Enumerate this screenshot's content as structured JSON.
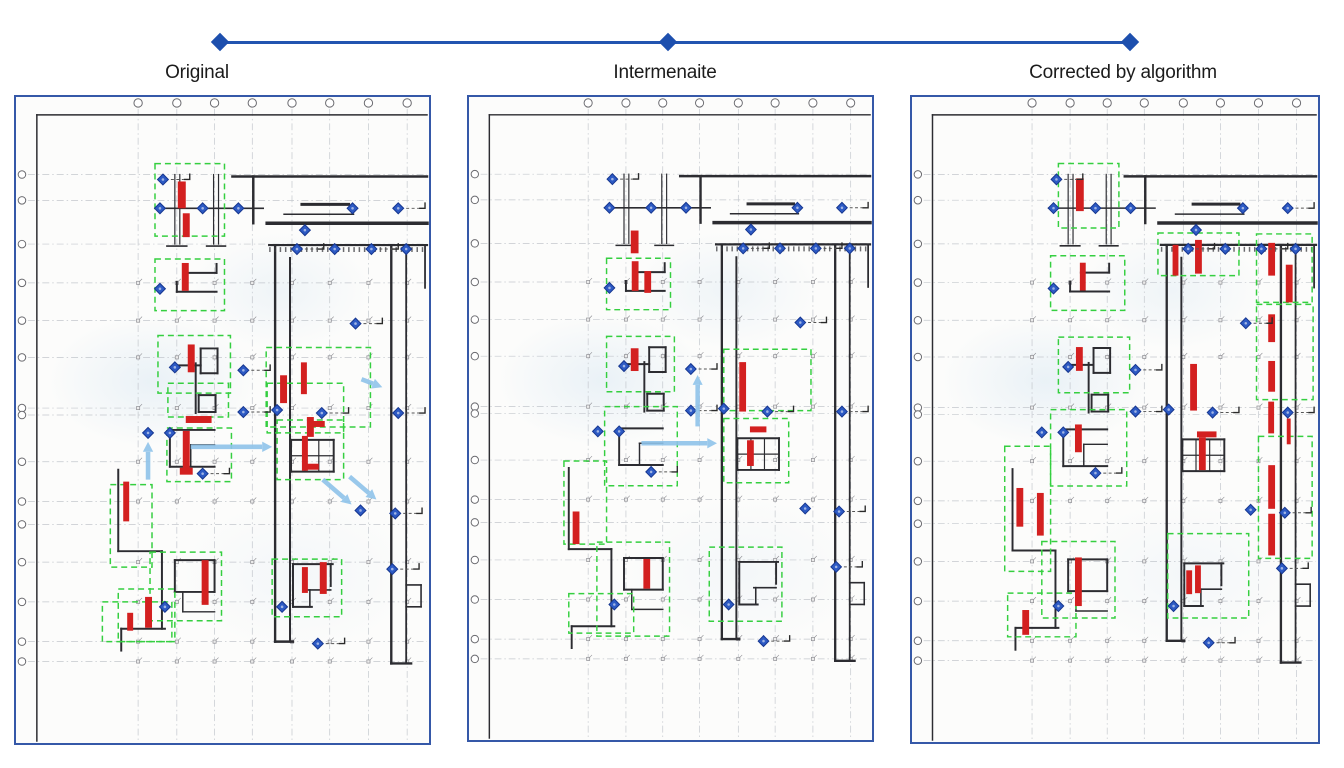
{
  "timeline": {
    "y": 42,
    "marker_xs": [
      220,
      668,
      1130
    ],
    "color": "#1d4fae",
    "line_color": "#2254b0"
  },
  "panels": [
    {
      "label": "Original",
      "red_marks": [
        [
          163,
          85,
          8,
          27
        ],
        [
          168,
          117,
          7,
          24
        ],
        [
          167,
          167,
          7,
          28
        ],
        [
          173,
          249,
          7,
          28
        ],
        [
          266,
          280,
          7,
          28
        ],
        [
          287,
          267,
          6,
          32
        ],
        [
          171,
          321,
          26,
          7
        ],
        [
          293,
          322,
          7,
          20
        ],
        [
          168,
          336,
          7,
          41
        ],
        [
          165,
          373,
          13,
          7
        ],
        [
          108,
          387,
          6,
          40
        ],
        [
          288,
          341,
          6,
          35
        ],
        [
          295,
          326,
          16,
          6
        ],
        [
          292,
          369,
          13,
          6
        ],
        [
          187,
          466,
          7,
          45
        ],
        [
          288,
          473,
          6,
          26
        ],
        [
          306,
          468,
          7,
          32
        ],
        [
          112,
          519,
          6,
          18
        ],
        [
          130,
          503,
          7,
          31
        ]
      ],
      "green_boxes": [
        [
          140,
          67,
          70,
          73
        ],
        [
          140,
          163,
          70,
          52
        ],
        [
          143,
          240,
          73,
          58
        ],
        [
          153,
          288,
          61,
          34
        ],
        [
          252,
          252,
          105,
          80
        ],
        [
          253,
          288,
          77,
          50
        ],
        [
          152,
          333,
          65,
          54
        ],
        [
          263,
          325,
          67,
          60
        ],
        [
          95,
          390,
          42,
          83
        ],
        [
          135,
          458,
          72,
          69
        ],
        [
          103,
          495,
          57,
          53
        ],
        [
          87,
          508,
          70,
          40
        ],
        [
          258,
          465,
          70,
          58
        ]
      ],
      "arrows": [
        [
          133,
          385,
          133,
          347
        ],
        [
          176,
          352,
          258,
          352
        ],
        [
          309,
          385,
          338,
          410
        ],
        [
          336,
          382,
          363,
          405
        ],
        [
          348,
          284,
          369,
          292
        ]
      ]
    },
    {
      "label": "Intermenaite",
      "red_marks": [
        [
          167,
          135,
          8,
          23
        ],
        [
          168,
          166,
          7,
          30
        ],
        [
          181,
          176,
          7,
          22
        ],
        [
          167,
          254,
          8,
          23
        ],
        [
          279,
          268,
          7,
          50
        ],
        [
          290,
          333,
          17,
          6
        ],
        [
          287,
          347,
          7,
          26
        ],
        [
          107,
          419,
          7,
          33
        ],
        [
          180,
          467,
          7,
          30
        ]
      ],
      "green_boxes": [
        [
          142,
          163,
          66,
          52
        ],
        [
          142,
          242,
          70,
          56
        ],
        [
          263,
          255,
          90,
          62
        ],
        [
          263,
          325,
          67,
          65
        ],
        [
          140,
          313,
          75,
          80
        ],
        [
          98,
          368,
          44,
          84
        ],
        [
          132,
          450,
          75,
          95
        ],
        [
          103,
          502,
          67,
          40
        ],
        [
          248,
          455,
          75,
          75
        ]
      ],
      "arrows": [
        [
          236,
          333,
          236,
          281
        ],
        [
          178,
          350,
          256,
          350
        ]
      ]
    },
    {
      "label": "Corrected by algorithm",
      "red_marks": [
        [
          168,
          82,
          8,
          33
        ],
        [
          172,
          167,
          6,
          28
        ],
        [
          168,
          252,
          7,
          24
        ],
        [
          267,
          149,
          6,
          31
        ],
        [
          290,
          144,
          7,
          34
        ],
        [
          365,
          147,
          7,
          33
        ],
        [
          383,
          169,
          7,
          38
        ],
        [
          365,
          219,
          7,
          28
        ],
        [
          365,
          266,
          7,
          31
        ],
        [
          285,
          269,
          7,
          47
        ],
        [
          167,
          330,
          7,
          28
        ],
        [
          292,
          337,
          20,
          6
        ],
        [
          294,
          343,
          7,
          33
        ],
        [
          365,
          307,
          6,
          32
        ],
        [
          384,
          324,
          4,
          26
        ],
        [
          107,
          394,
          7,
          39
        ],
        [
          128,
          399,
          7,
          43
        ],
        [
          365,
          371,
          7,
          44
        ],
        [
          365,
          420,
          7,
          42
        ],
        [
          167,
          464,
          7,
          49
        ],
        [
          281,
          477,
          6,
          24
        ],
        [
          290,
          472,
          6,
          28
        ],
        [
          113,
          517,
          7,
          25
        ]
      ],
      "green_boxes": [
        [
          150,
          67,
          62,
          65
        ],
        [
          142,
          160,
          76,
          55
        ],
        [
          150,
          242,
          73,
          56
        ],
        [
          252,
          137,
          83,
          43
        ],
        [
          353,
          138,
          57,
          69
        ],
        [
          353,
          209,
          58,
          96
        ],
        [
          355,
          342,
          55,
          123
        ],
        [
          262,
          440,
          83,
          85
        ],
        [
          95,
          352,
          47,
          126
        ],
        [
          142,
          315,
          78,
          77
        ],
        [
          133,
          448,
          75,
          77
        ],
        [
          98,
          500,
          70,
          44
        ]
      ],
      "arrows": []
    }
  ],
  "base_plan": {
    "view": [
      416,
      650
    ],
    "colors": {
      "grid": "#c3c7cd",
      "bubble": "#6a6a6f",
      "wall": "#2c2c31",
      "red": "#d32020",
      "green": "#35cf40",
      "diamond_fill": "#2d5ac4",
      "diamond_edge": "#16368f",
      "arrow": "#8fc3ea",
      "marker": "#8d8d92",
      "stub": "#2a2a2a"
    },
    "grid": {
      "vx": [
        123,
        162,
        200,
        238,
        278,
        316,
        355,
        394
      ],
      "hy": [
        78,
        104,
        148,
        187,
        225,
        262,
        313,
        320,
        367,
        407,
        430,
        468,
        508,
        548,
        568
      ]
    },
    "marker_ys": [
      187,
      225,
      262,
      313,
      367,
      407,
      468,
      508,
      548,
      568
    ],
    "walls": [
      [
        21,
        18,
        21,
        648,
        1.5
      ],
      [
        21,
        18,
        414,
        18,
        1.5
      ],
      [
        218,
        80,
        414,
        80,
        2.5
      ],
      [
        239,
        80,
        239,
        127,
        2.5
      ],
      [
        288,
        108,
        335,
        108,
        3
      ],
      [
        270,
        118,
        340,
        118,
        1.5
      ],
      [
        253,
        127,
        414,
        127,
        3.5
      ],
      [
        255,
        149,
        414,
        149,
        2.2
      ],
      [
        160,
        78,
        160,
        148,
        1.2
      ],
      [
        165,
        78,
        165,
        148,
        1.2
      ],
      [
        199,
        78,
        199,
        148,
        1.2
      ],
      [
        204,
        78,
        204,
        148,
        1.2
      ],
      [
        140,
        112,
        249,
        112,
        1.6
      ],
      [
        152,
        150,
        172,
        150,
        1.6
      ],
      [
        192,
        150,
        211,
        150,
        1.6
      ],
      [
        173,
        177,
        202,
        177,
        2
      ],
      [
        202,
        168,
        202,
        177,
        2
      ],
      [
        162,
        196,
        202,
        196,
        2
      ],
      [
        162,
        186,
        162,
        196,
        2
      ],
      [
        161,
        270,
        186,
        270,
        2
      ],
      [
        186,
        253,
        203,
        253,
        2
      ],
      [
        186,
        253,
        186,
        278,
        2
      ],
      [
        203,
        253,
        203,
        278,
        2
      ],
      [
        186,
        278,
        203,
        278,
        2
      ],
      [
        181,
        268,
        181,
        318,
        2
      ],
      [
        184,
        300,
        201,
        300,
        2
      ],
      [
        184,
        300,
        184,
        317,
        2
      ],
      [
        201,
        300,
        201,
        317,
        2
      ],
      [
        184,
        317,
        201,
        317,
        2
      ],
      [
        155,
        335,
        200,
        335,
        2
      ],
      [
        155,
        335,
        155,
        372,
        2
      ],
      [
        155,
        372,
        200,
        372,
        2
      ],
      [
        176,
        350,
        200,
        350,
        1.5
      ],
      [
        176,
        350,
        176,
        372,
        1.5
      ],
      [
        277,
        345,
        320,
        345,
        2
      ],
      [
        277,
        345,
        277,
        377,
        2
      ],
      [
        320,
        345,
        320,
        377,
        2
      ],
      [
        277,
        377,
        320,
        377,
        2
      ],
      [
        291,
        345,
        291,
        377,
        1.2
      ],
      [
        305,
        345,
        305,
        377,
        1.2
      ],
      [
        277,
        361,
        320,
        361,
        1.2
      ],
      [
        261,
        150,
        261,
        548,
        2.4
      ],
      [
        276,
        162,
        276,
        548,
        2
      ],
      [
        261,
        548,
        279,
        548,
        2.4
      ],
      [
        378,
        150,
        378,
        570,
        2.4
      ],
      [
        393,
        150,
        393,
        570,
        1.8
      ],
      [
        378,
        570,
        398,
        570,
        2.4
      ],
      [
        393,
        491,
        408,
        491,
        1.6
      ],
      [
        408,
        491,
        408,
        513,
        1.6
      ],
      [
        393,
        513,
        408,
        513,
        1.6
      ],
      [
        412,
        150,
        412,
        192,
        1.8
      ],
      [
        103,
        375,
        103,
        457,
        2
      ],
      [
        103,
        457,
        147,
        457,
        2
      ],
      [
        147,
        457,
        147,
        535,
        2
      ],
      [
        106,
        535,
        150,
        535,
        2
      ],
      [
        106,
        535,
        106,
        557,
        2
      ],
      [
        160,
        466,
        200,
        466,
        2
      ],
      [
        160,
        466,
        160,
        498,
        2
      ],
      [
        200,
        466,
        200,
        498,
        2
      ],
      [
        160,
        498,
        200,
        498,
        2
      ],
      [
        168,
        498,
        168,
        518,
        1.5
      ],
      [
        168,
        518,
        200,
        518,
        1.5
      ],
      [
        279,
        470,
        319,
        470,
        2
      ],
      [
        279,
        470,
        279,
        513,
        2
      ],
      [
        317,
        470,
        317,
        492,
        2
      ],
      [
        294,
        496,
        317,
        496,
        1.6
      ],
      [
        296,
        496,
        296,
        513,
        1.6
      ],
      [
        279,
        513,
        298,
        513,
        2
      ]
    ],
    "hatch_band": {
      "x1": 255,
      "x2": 414,
      "y": 153.5
    },
    "diamonds": [
      [
        148,
        83,
        1
      ],
      [
        145,
        112,
        0
      ],
      [
        188,
        112,
        0
      ],
      [
        224,
        112,
        0
      ],
      [
        339,
        112,
        0
      ],
      [
        385,
        112,
        1
      ],
      [
        291,
        134,
        0
      ],
      [
        283,
        153,
        1
      ],
      [
        321,
        153,
        0
      ],
      [
        358,
        153,
        1
      ],
      [
        393,
        153,
        0
      ],
      [
        145,
        193,
        0
      ],
      [
        160,
        272,
        0
      ],
      [
        229,
        275,
        1
      ],
      [
        342,
        228,
        1
      ],
      [
        229,
        317,
        1
      ],
      [
        263,
        315,
        0
      ],
      [
        308,
        318,
        1
      ],
      [
        385,
        318,
        1
      ],
      [
        133,
        338,
        0
      ],
      [
        155,
        338,
        0
      ],
      [
        188,
        379,
        1
      ],
      [
        347,
        416,
        0
      ],
      [
        382,
        419,
        1
      ],
      [
        150,
        513,
        0
      ],
      [
        268,
        513,
        0
      ],
      [
        304,
        550,
        1
      ],
      [
        379,
        475,
        1
      ]
    ]
  }
}
